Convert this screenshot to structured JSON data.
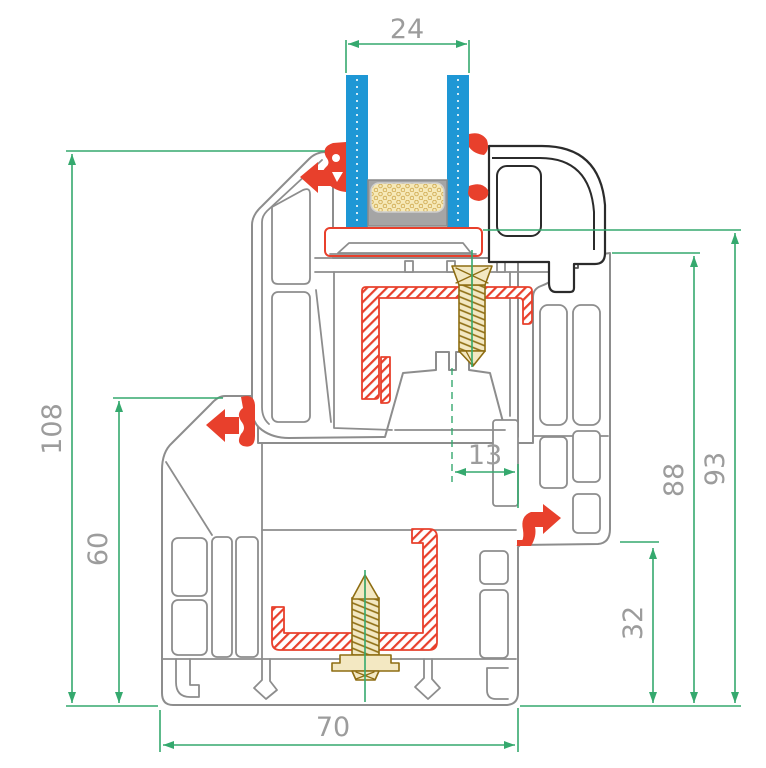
{
  "drawing": {
    "kind": "window-profile-cross-section",
    "dimensions": {
      "glazing_thickness": {
        "value": "24"
      },
      "overall_height": {
        "value": "108"
      },
      "frame_height": {
        "value": "60"
      },
      "hardware_axis_offset": {
        "value": "13"
      },
      "sash_height": {
        "value": "88"
      },
      "frame_sash_height": {
        "value": "93"
      },
      "sill_ledge_height": {
        "value": "32"
      },
      "profile_depth": {
        "value": "70"
      }
    },
    "components": [
      "frame-profile",
      "sash-profile",
      "glazing-bead",
      "glass-pane-left",
      "glass-pane-right",
      "spacer-bar",
      "desiccant",
      "glazing-packer",
      "steel-reinforcement-upper",
      "steel-reinforcement-lower",
      "screw-upper",
      "screw-lower",
      "gaskets"
    ]
  },
  "colors": {
    "dim_green": "#35a96e",
    "label_gray": "#9c9c9c",
    "profile_gray": "#8d8d8d",
    "bead_dark": "#2b2b2b",
    "seal_red": "#e8402c",
    "glass_blue": "#1e97d5",
    "screw_tan": "#8e6d12",
    "spacer_gray": "#a5a5a5",
    "desiccant_tan": "#f6e9b8"
  }
}
